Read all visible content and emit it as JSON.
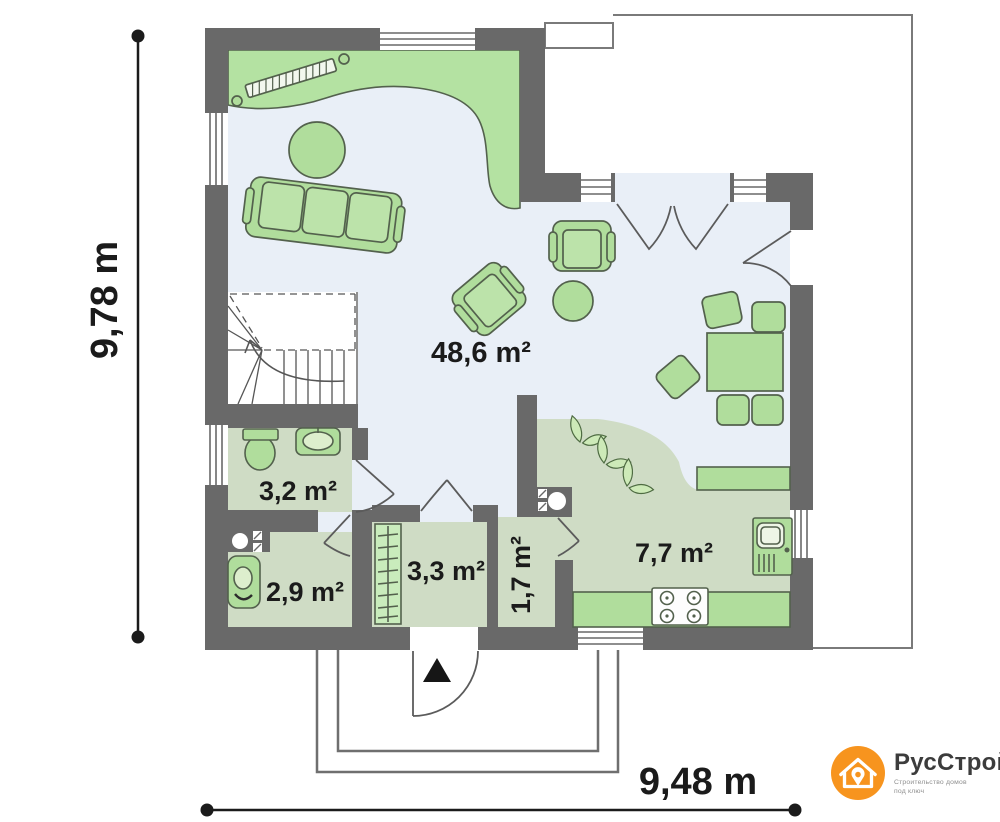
{
  "plan": {
    "rooms": [
      {
        "name": "living-dining-room",
        "area_label": "48,6 m²"
      },
      {
        "name": "bathroom",
        "area_label": "3,2 m²"
      },
      {
        "name": "wc",
        "area_label": "2,9 m²"
      },
      {
        "name": "entry-tambour",
        "area_label": "3,3 m²"
      },
      {
        "name": "hall",
        "area_label": "1,7 m²"
      },
      {
        "name": "kitchen",
        "area_label": "7,7 m²"
      }
    ],
    "dimensions": {
      "vertical_label": "9,78 m",
      "horizontal_label": "9,48 m"
    },
    "colors": {
      "wall": "#696969",
      "floor_main": "#e9eff7",
      "floor_rooms": "#cfdcc5",
      "furniture_fill": "#b0dd9c",
      "furniture_stroke": "#53614d"
    }
  },
  "logo": {
    "brand": "РусСтрой",
    "tagline_line1": "Строительство домов",
    "tagline_line2": "под ключ",
    "accent_color": "#F7941E",
    "icon": "house-pin-icon"
  }
}
